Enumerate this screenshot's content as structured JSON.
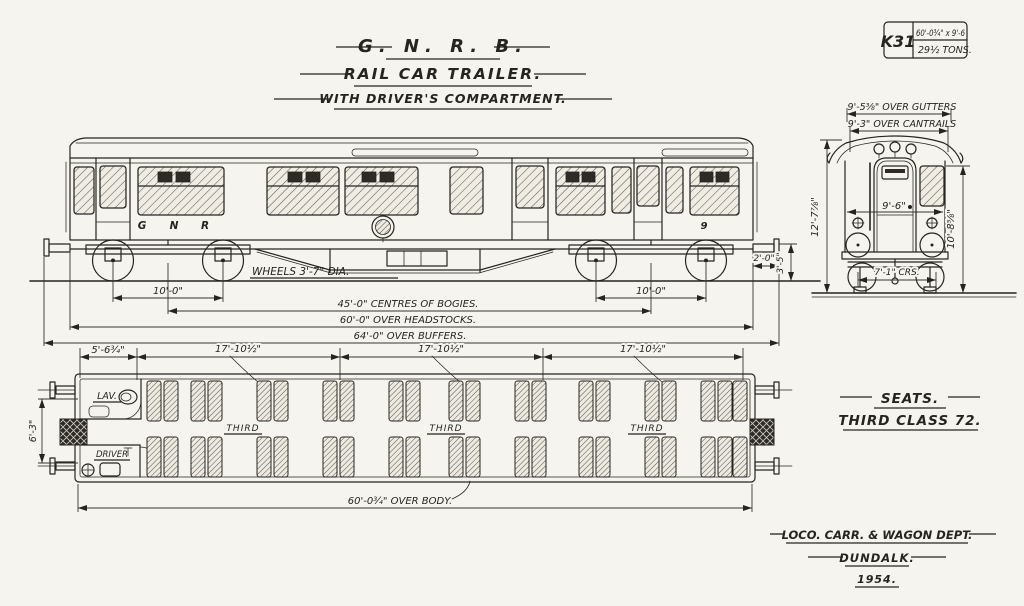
{
  "colors": {
    "paper": "#f6f4ee",
    "ink": "#262420"
  },
  "title": {
    "railway": "G. N. R. B.",
    "subject": "RAIL CAR TRAILER.",
    "variant": "WITH DRIVER'S COMPARTMENT."
  },
  "ref_box": {
    "code": "K31",
    "size": "60'-0¾\" x 9'-6",
    "weight": "29½ TONS."
  },
  "side": {
    "letter_g": "G",
    "letter_n": "N",
    "letter_r": "R",
    "number": "9",
    "wheels": "WHEELS 3'-7\" DIA.",
    "wheelbase": "10'-0\"",
    "bogie_centres": "45'-0\" CENTRES OF BOGIES.",
    "over_headstocks": "60'-0\" OVER HEADSTOCKS.",
    "over_buffers": "64'-0\" OVER BUFFERS.",
    "buffer_proj": "2'-0\"",
    "buffer_height": "3'-5\""
  },
  "end": {
    "over_gutters": "9'-5⅜\" OVER GUTTERS",
    "over_cantrails": "9'-3\" OVER CANTRAILS",
    "roof_height": "12'-7⅞\"",
    "body_width": "9'-6\"",
    "side_height": "10'-8⅝\"",
    "axle_crs": "7'-1\" CRS."
  },
  "plan": {
    "lav": "LAV.",
    "driver": "DRIVER",
    "third": "THIRD",
    "end_bay": "5'-6¾\"",
    "bay": "17'-10½\"",
    "inside_width": "6'-3\"",
    "over_body": "60'-0¾\" OVER BODY."
  },
  "seats_note": {
    "heading": "SEATS.",
    "detail": "THIRD CLASS 72."
  },
  "footer": {
    "dept": "LOCO. CARR. & WAGON DEPT.",
    "place": "DUNDALK.",
    "year": "1954."
  }
}
